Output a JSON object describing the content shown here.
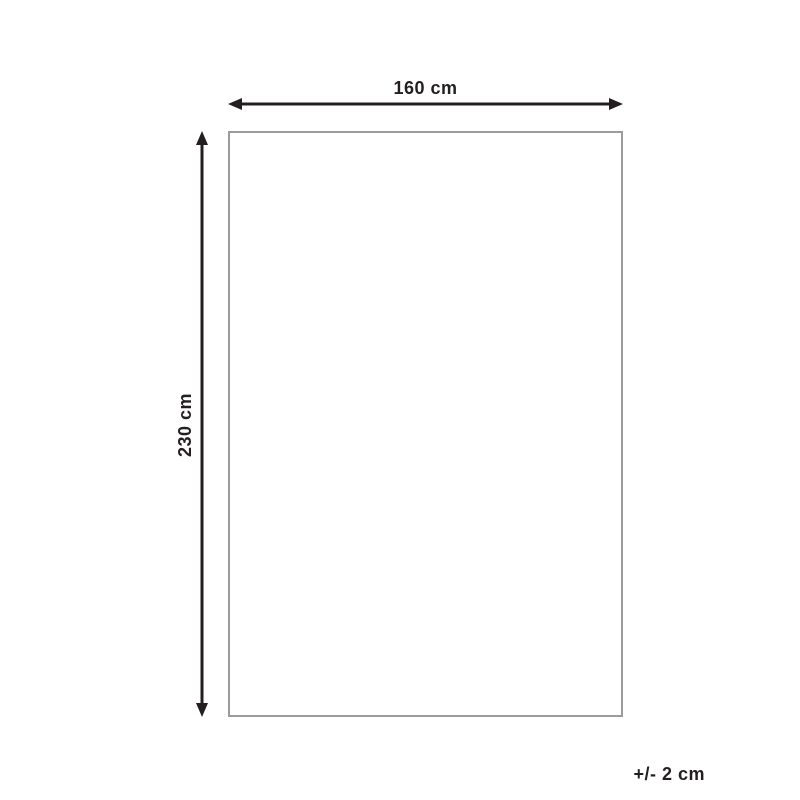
{
  "diagram": {
    "type": "product-dimension-diagram",
    "width_dimension": {
      "label": "160 cm"
    },
    "height_dimension": {
      "label": "230 cm"
    },
    "tolerance": {
      "label": "+/- 2 cm"
    },
    "colors": {
      "arrow": "#231f20",
      "outline": "#9b9b9b",
      "background": "#ffffff"
    }
  }
}
